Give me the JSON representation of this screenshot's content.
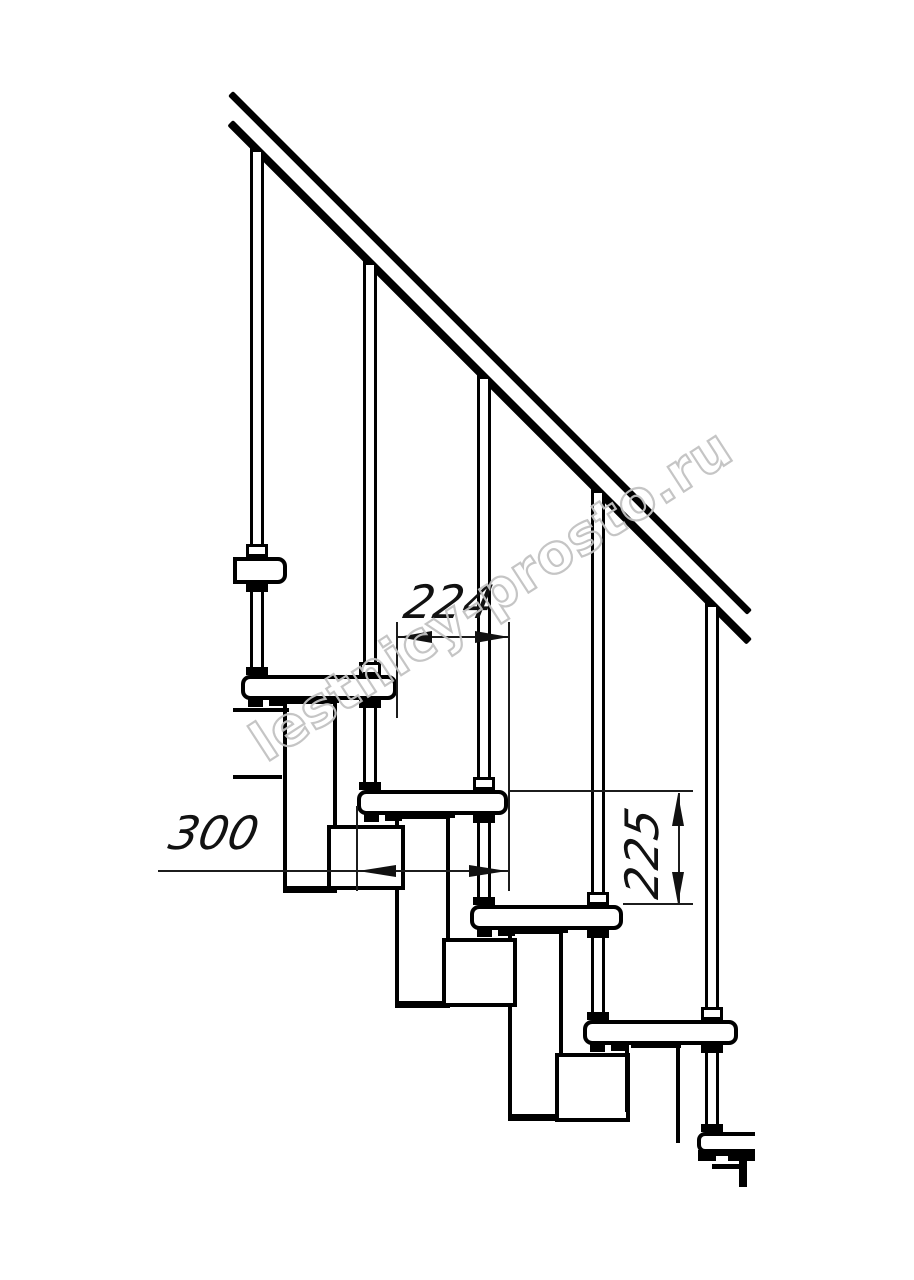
{
  "drawing": {
    "watermark_text": "lestnicy-prosto.ru",
    "watermark_color": "#c2c2c2",
    "line_color": "#000000",
    "background_color": "#ffffff",
    "dimensions": {
      "going": "224",
      "tread_depth": "300",
      "step_rise": "225"
    },
    "geometry": {
      "rails": [
        {
          "x": 233,
          "y": 91,
          "len": 734,
          "th": 7
        },
        {
          "x": 233,
          "y": 120,
          "len": 734,
          "th": 8
        }
      ],
      "balusters": [
        {
          "cx": 257,
          "y1": 152,
          "y2": 557
        },
        {
          "cx": 370,
          "y1": 265,
          "y2": 675
        },
        {
          "cx": 484,
          "y1": 379,
          "y2": 790
        },
        {
          "cx": 598,
          "y1": 493,
          "y2": 905
        },
        {
          "cx": 712,
          "y1": 607,
          "y2": 1020
        }
      ],
      "legs": [
        {
          "cx": 257,
          "y1": 584,
          "y2": 675
        },
        {
          "cx": 370,
          "y1": 700,
          "y2": 790
        },
        {
          "cx": 484,
          "y1": 815,
          "y2": 905
        },
        {
          "cx": 598,
          "y1": 930,
          "y2": 1020
        },
        {
          "cx": 712,
          "y1": 1045,
          "y2": 1132
        }
      ],
      "uprights": [
        {
          "x": 283,
          "y": 700,
          "w": 54,
          "h": 193
        },
        {
          "x": 395,
          "y": 815,
          "w": 55,
          "h": 193
        },
        {
          "x": 508,
          "y": 930,
          "w": 55,
          "h": 191
        }
      ],
      "squares": [
        {
          "x": 327,
          "y": 825,
          "w": 78,
          "h": 65
        },
        {
          "x": 442,
          "y": 938,
          "w": 75,
          "h": 69
        },
        {
          "x": 555,
          "y": 1053,
          "w": 75,
          "h": 69
        }
      ],
      "treads": [
        {
          "x": 233,
          "y": 557,
          "w": 54,
          "h": 27,
          "r": "0 9px 9px 0",
          "feet": false,
          "cut": false
        },
        {
          "x": 241,
          "y": 675,
          "w": 156,
          "h": 25,
          "r": "9px",
          "feet": true,
          "cut": false
        },
        {
          "x": 357,
          "y": 790,
          "w": 151,
          "h": 25,
          "r": "9px",
          "feet": true,
          "cut": false
        },
        {
          "x": 470,
          "y": 905,
          "w": 153,
          "h": 25,
          "r": "9px",
          "feet": true,
          "cut": false
        },
        {
          "x": 583,
          "y": 1020,
          "w": 155,
          "h": 25,
          "r": "9px",
          "feet": true,
          "cut": false
        },
        {
          "x": 697,
          "y": 1132,
          "w": 58,
          "h": 21,
          "r": "8px 0 0 8px",
          "feet": false,
          "cut": true
        }
      ],
      "solids": [
        {
          "x": 233,
          "y": 708,
          "w": 56,
          "h": 4,
          "n": "landing-edge-line"
        },
        {
          "x": 233,
          "y": 775,
          "w": 49,
          "h": 4,
          "n": "landing-edge-line"
        },
        {
          "x": 625,
          "y": 1045,
          "w": 4,
          "h": 67,
          "n": "module-cut-line"
        },
        {
          "x": 676,
          "y": 1045,
          "w": 4,
          "h": 98,
          "n": "module-cut-line"
        },
        {
          "x": 698,
          "y": 1150,
          "w": 57,
          "h": 11,
          "n": "bottom-tread-foot"
        },
        {
          "x": 712,
          "y": 1164,
          "w": 30,
          "h": 5,
          "n": "bottom-step-line"
        },
        {
          "x": 739,
          "y": 1160,
          "w": 8,
          "h": 27,
          "n": "bottom-cut-line"
        }
      ],
      "whites": [
        {
          "x": 716,
          "y": 1156,
          "w": 12,
          "h": 6
        }
      ],
      "extlines": [
        {
          "x": 396,
          "y": 622,
          "w": 2,
          "h": 96
        },
        {
          "x": 508,
          "y": 622,
          "w": 2,
          "h": 269
        },
        {
          "x": 356,
          "y": 806,
          "w": 2,
          "h": 85
        },
        {
          "x": 508,
          "y": 790,
          "w": 185,
          "h": 2
        },
        {
          "x": 623,
          "y": 903,
          "w": 70,
          "h": 2
        },
        {
          "x": 397,
          "y": 636,
          "w": 112,
          "h": 2
        },
        {
          "x": 158,
          "y": 870,
          "w": 350,
          "h": 2
        },
        {
          "x": 678,
          "y": 793,
          "w": 2,
          "h": 112
        }
      ],
      "arrows": [
        {
          "x": 398,
          "y": 631,
          "w": 34,
          "h": 12,
          "dir": "l"
        },
        {
          "x": 475,
          "y": 631,
          "w": 34,
          "h": 12,
          "dir": "r"
        },
        {
          "x": 358,
          "y": 865,
          "w": 38,
          "h": 12,
          "dir": "l"
        },
        {
          "x": 469,
          "y": 865,
          "w": 38,
          "h": 12,
          "dir": "r"
        },
        {
          "x": 672,
          "y": 794,
          "w": 12,
          "h": 32,
          "dir": "u"
        },
        {
          "x": 672,
          "y": 872,
          "w": 12,
          "h": 32,
          "dir": "d"
        }
      ]
    }
  }
}
